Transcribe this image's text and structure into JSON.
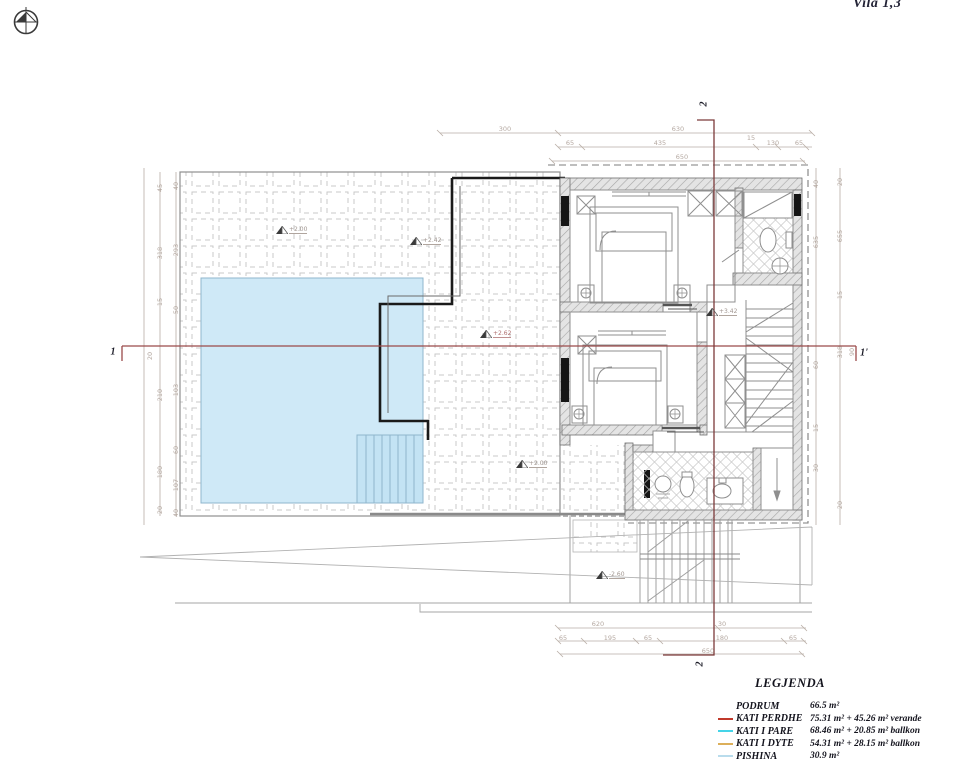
{
  "meta": {
    "title": "Vila 1,3"
  },
  "legend": {
    "title": "LEGJENDA",
    "rows": [
      {
        "name": "PODRUM",
        "area": "66.5 m²",
        "color": ""
      },
      {
        "name": "KATI PERDHE",
        "area": "75.31 m² + 45.26 m² verande",
        "color": "#c0392b"
      },
      {
        "name": "KATI I PARE",
        "area": "68.46 m² + 20.85 m² ballkon",
        "color": "#45d4e8"
      },
      {
        "name": "KATI I DYTE",
        "area": "54.31 m² + 28.15 m² ballkon",
        "color": "#dcaf5a"
      },
      {
        "name": "PISHINA",
        "area": "30.9 m²",
        "color": "#b9dcec"
      }
    ]
  },
  "section_labels": [
    {
      "text": "1",
      "x": 113,
      "y": 352,
      "rot": 0
    },
    {
      "text": "1'",
      "x": 864,
      "y": 353,
      "rot": 0
    },
    {
      "text": "2",
      "x": 704,
      "y": 104,
      "rot": -90
    },
    {
      "text": "2",
      "x": 700,
      "y": 664,
      "rot": -90
    }
  ],
  "level_markers": [
    {
      "value": "+2.00",
      "x": 278,
      "y": 232,
      "red": false
    },
    {
      "value": "+2.42",
      "x": 412,
      "y": 243,
      "red": false
    },
    {
      "value": "+2.62",
      "x": 482,
      "y": 336,
      "red": true
    },
    {
      "value": "+2.00",
      "x": 518,
      "y": 466,
      "red": false
    },
    {
      "value": "+3.42",
      "x": 708,
      "y": 314,
      "red": false
    },
    {
      "value": "-2.60",
      "x": 598,
      "y": 577,
      "red": false
    }
  ],
  "dim_labels": [
    {
      "t": "300",
      "x": 505,
      "y": 129,
      "r": 0
    },
    {
      "t": "630",
      "x": 678,
      "y": 129,
      "r": 0
    },
    {
      "t": "65",
      "x": 570,
      "y": 143,
      "r": 0
    },
    {
      "t": "435",
      "x": 660,
      "y": 143,
      "r": 0
    },
    {
      "t": "15",
      "x": 751,
      "y": 138,
      "r": 0
    },
    {
      "t": "130",
      "x": 773,
      "y": 143,
      "r": 0
    },
    {
      "t": "65",
      "x": 799,
      "y": 143,
      "r": 0
    },
    {
      "t": "650",
      "x": 682,
      "y": 157,
      "r": 0
    },
    {
      "t": "620",
      "x": 598,
      "y": 624,
      "r": 0
    },
    {
      "t": "30",
      "x": 722,
      "y": 624,
      "r": 0
    },
    {
      "t": "65",
      "x": 563,
      "y": 638,
      "r": 0
    },
    {
      "t": "195",
      "x": 610,
      "y": 638,
      "r": 0
    },
    {
      "t": "65",
      "x": 648,
      "y": 638,
      "r": 0
    },
    {
      "t": "180",
      "x": 722,
      "y": 638,
      "r": 0
    },
    {
      "t": "65",
      "x": 793,
      "y": 638,
      "r": 0
    },
    {
      "t": "650",
      "x": 708,
      "y": 651,
      "r": 0
    },
    {
      "t": "45",
      "x": 160,
      "y": 188,
      "r": -90
    },
    {
      "t": "318",
      "x": 160,
      "y": 253,
      "r": -90
    },
    {
      "t": "15",
      "x": 160,
      "y": 302,
      "r": -90
    },
    {
      "t": "210",
      "x": 160,
      "y": 395,
      "r": -90
    },
    {
      "t": "180",
      "x": 160,
      "y": 472,
      "r": -90
    },
    {
      "t": "20",
      "x": 160,
      "y": 510,
      "r": -90
    },
    {
      "t": "40",
      "x": 176,
      "y": 186,
      "r": -90
    },
    {
      "t": "293",
      "x": 176,
      "y": 250,
      "r": -90
    },
    {
      "t": "50",
      "x": 176,
      "y": 310,
      "r": -90
    },
    {
      "t": "103",
      "x": 176,
      "y": 390,
      "r": -90
    },
    {
      "t": "60",
      "x": 176,
      "y": 450,
      "r": -90
    },
    {
      "t": "107",
      "x": 176,
      "y": 485,
      "r": -90
    },
    {
      "t": "40",
      "x": 176,
      "y": 513,
      "r": -90
    },
    {
      "t": "20",
      "x": 150,
      "y": 356,
      "r": -90
    },
    {
      "t": "40",
      "x": 816,
      "y": 184,
      "r": -90
    },
    {
      "t": "635",
      "x": 816,
      "y": 242,
      "r": -90
    },
    {
      "t": "60",
      "x": 816,
      "y": 365,
      "r": -90
    },
    {
      "t": "15",
      "x": 816,
      "y": 428,
      "r": -90
    },
    {
      "t": "30",
      "x": 816,
      "y": 468,
      "r": -90
    },
    {
      "t": "20",
      "x": 840,
      "y": 182,
      "r": -90
    },
    {
      "t": "655",
      "x": 840,
      "y": 236,
      "r": -90
    },
    {
      "t": "15",
      "x": 840,
      "y": 295,
      "r": -90
    },
    {
      "t": "318",
      "x": 840,
      "y": 352,
      "r": -90
    },
    {
      "t": "90",
      "x": 852,
      "y": 352,
      "r": -90
    },
    {
      "t": "20",
      "x": 840,
      "y": 505,
      "r": -90
    }
  ],
  "colors": {
    "pool_fill": "#cfe9f7",
    "pool_steps": "#c3e3f4",
    "section_line_h": "#9a4a4a",
    "section_line_v": "#7c3a3a",
    "heavy_wall": "#1a1a1a",
    "dim_text": "#b5a9a2"
  }
}
